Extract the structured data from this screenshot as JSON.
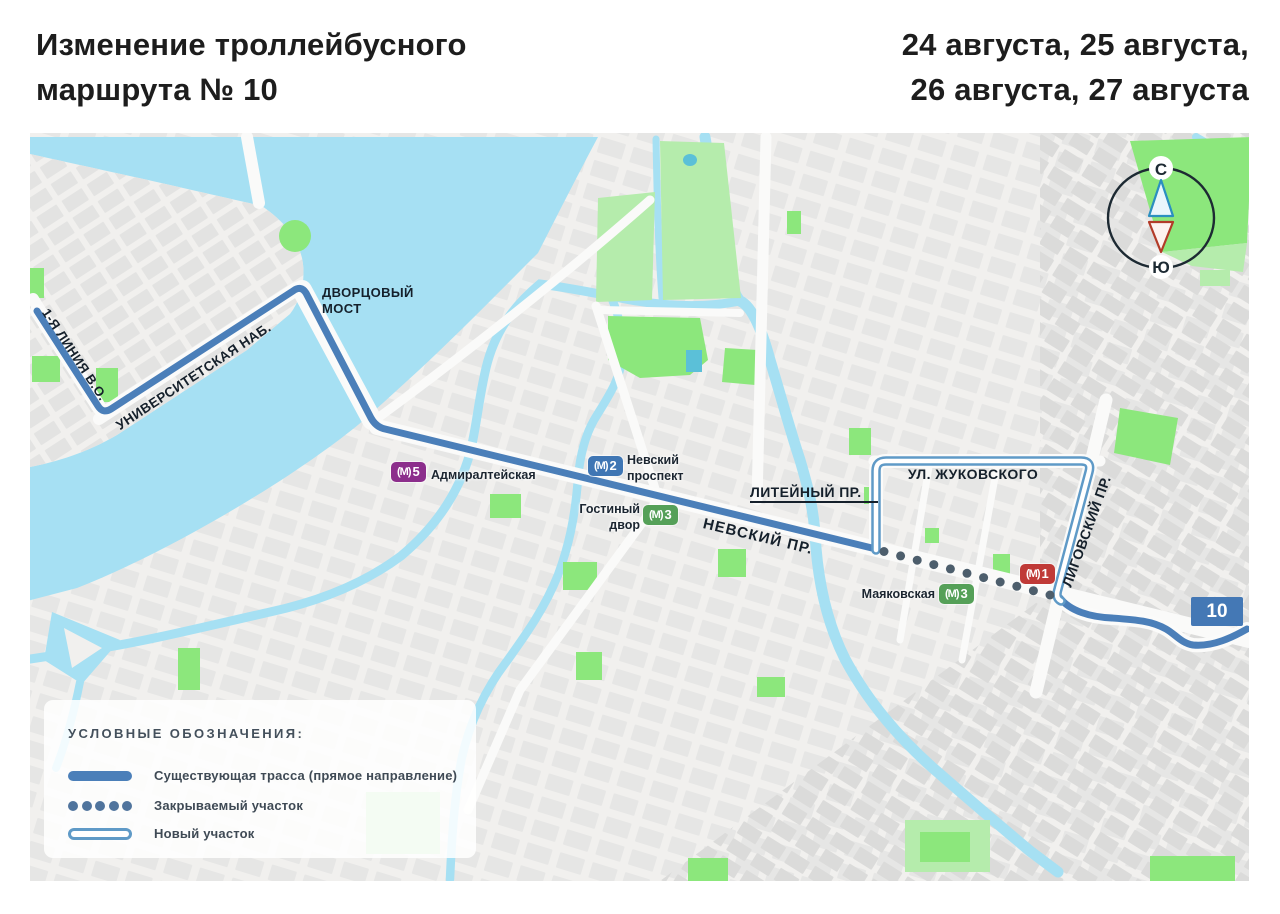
{
  "header": {
    "title_line1": "Изменение троллейбусного",
    "title_line2": "маршрута № 10",
    "dates_line1": "24 августа, 25 августа,",
    "dates_line2": "26 августа, 27 августа"
  },
  "map": {
    "street_labels": {
      "liniya": "1-Я ЛИНИЯ В.О.",
      "universitetskaya": "УНИВЕРСИТЕТСКАЯ НАБ.",
      "dvortsovy_line1": "ДВОРЦОВЫЙ",
      "dvortsovy_line2": "МОСТ",
      "nevsky": "НЕВСКИЙ ПР.",
      "liteiny": "ЛИТЕЙНЫЙ ПР.",
      "zhukovskogo": "УЛ. ЖУКОВСКОГО",
      "ligovsky": "ЛИГОВСКИЙ ПР."
    },
    "compass": {
      "north": "С",
      "south": "Ю"
    },
    "route_badge": "10",
    "metro": {
      "logo": "(М)",
      "stations": [
        {
          "id": "admiralteyskaya",
          "line": "5",
          "color": "#8c2e8c",
          "label": "Адмиралтейская"
        },
        {
          "id": "nevsky-prospekt",
          "line": "2",
          "color": "#3f76b4",
          "label_line1": "Невский",
          "label_line2": "проспект"
        },
        {
          "id": "gostiny-dvor",
          "line": "3",
          "color": "#55a058",
          "label_line1": "Гостиный",
          "label_line2": "двор"
        },
        {
          "id": "mayakovskaya",
          "line": "3",
          "color": "#55a058",
          "label": "Маяковская"
        },
        {
          "id": "metro-line1-station",
          "line": "1",
          "color": "#c03a37",
          "label": ""
        }
      ]
    }
  },
  "legend": {
    "title": "УСЛОВНЫЕ ОБОЗНАЧЕНИЯ:",
    "items": [
      {
        "type": "solid-line",
        "label": "Существующая трасса (прямое направление)"
      },
      {
        "type": "dotted-line",
        "label": "Закрываемый участок"
      },
      {
        "type": "outlined-line",
        "label": "Новый участок"
      }
    ]
  },
  "colors": {
    "route_blue": "#4b7fb9",
    "new_section_outline": "#5f9ac7",
    "closed_section_dot": "#4d5e6c",
    "water": "#a6e0f3",
    "park_bright": "#8ce77c",
    "park_light": "#b5ecac",
    "land": "#f1f0ee",
    "text_dark": "#15202b"
  }
}
